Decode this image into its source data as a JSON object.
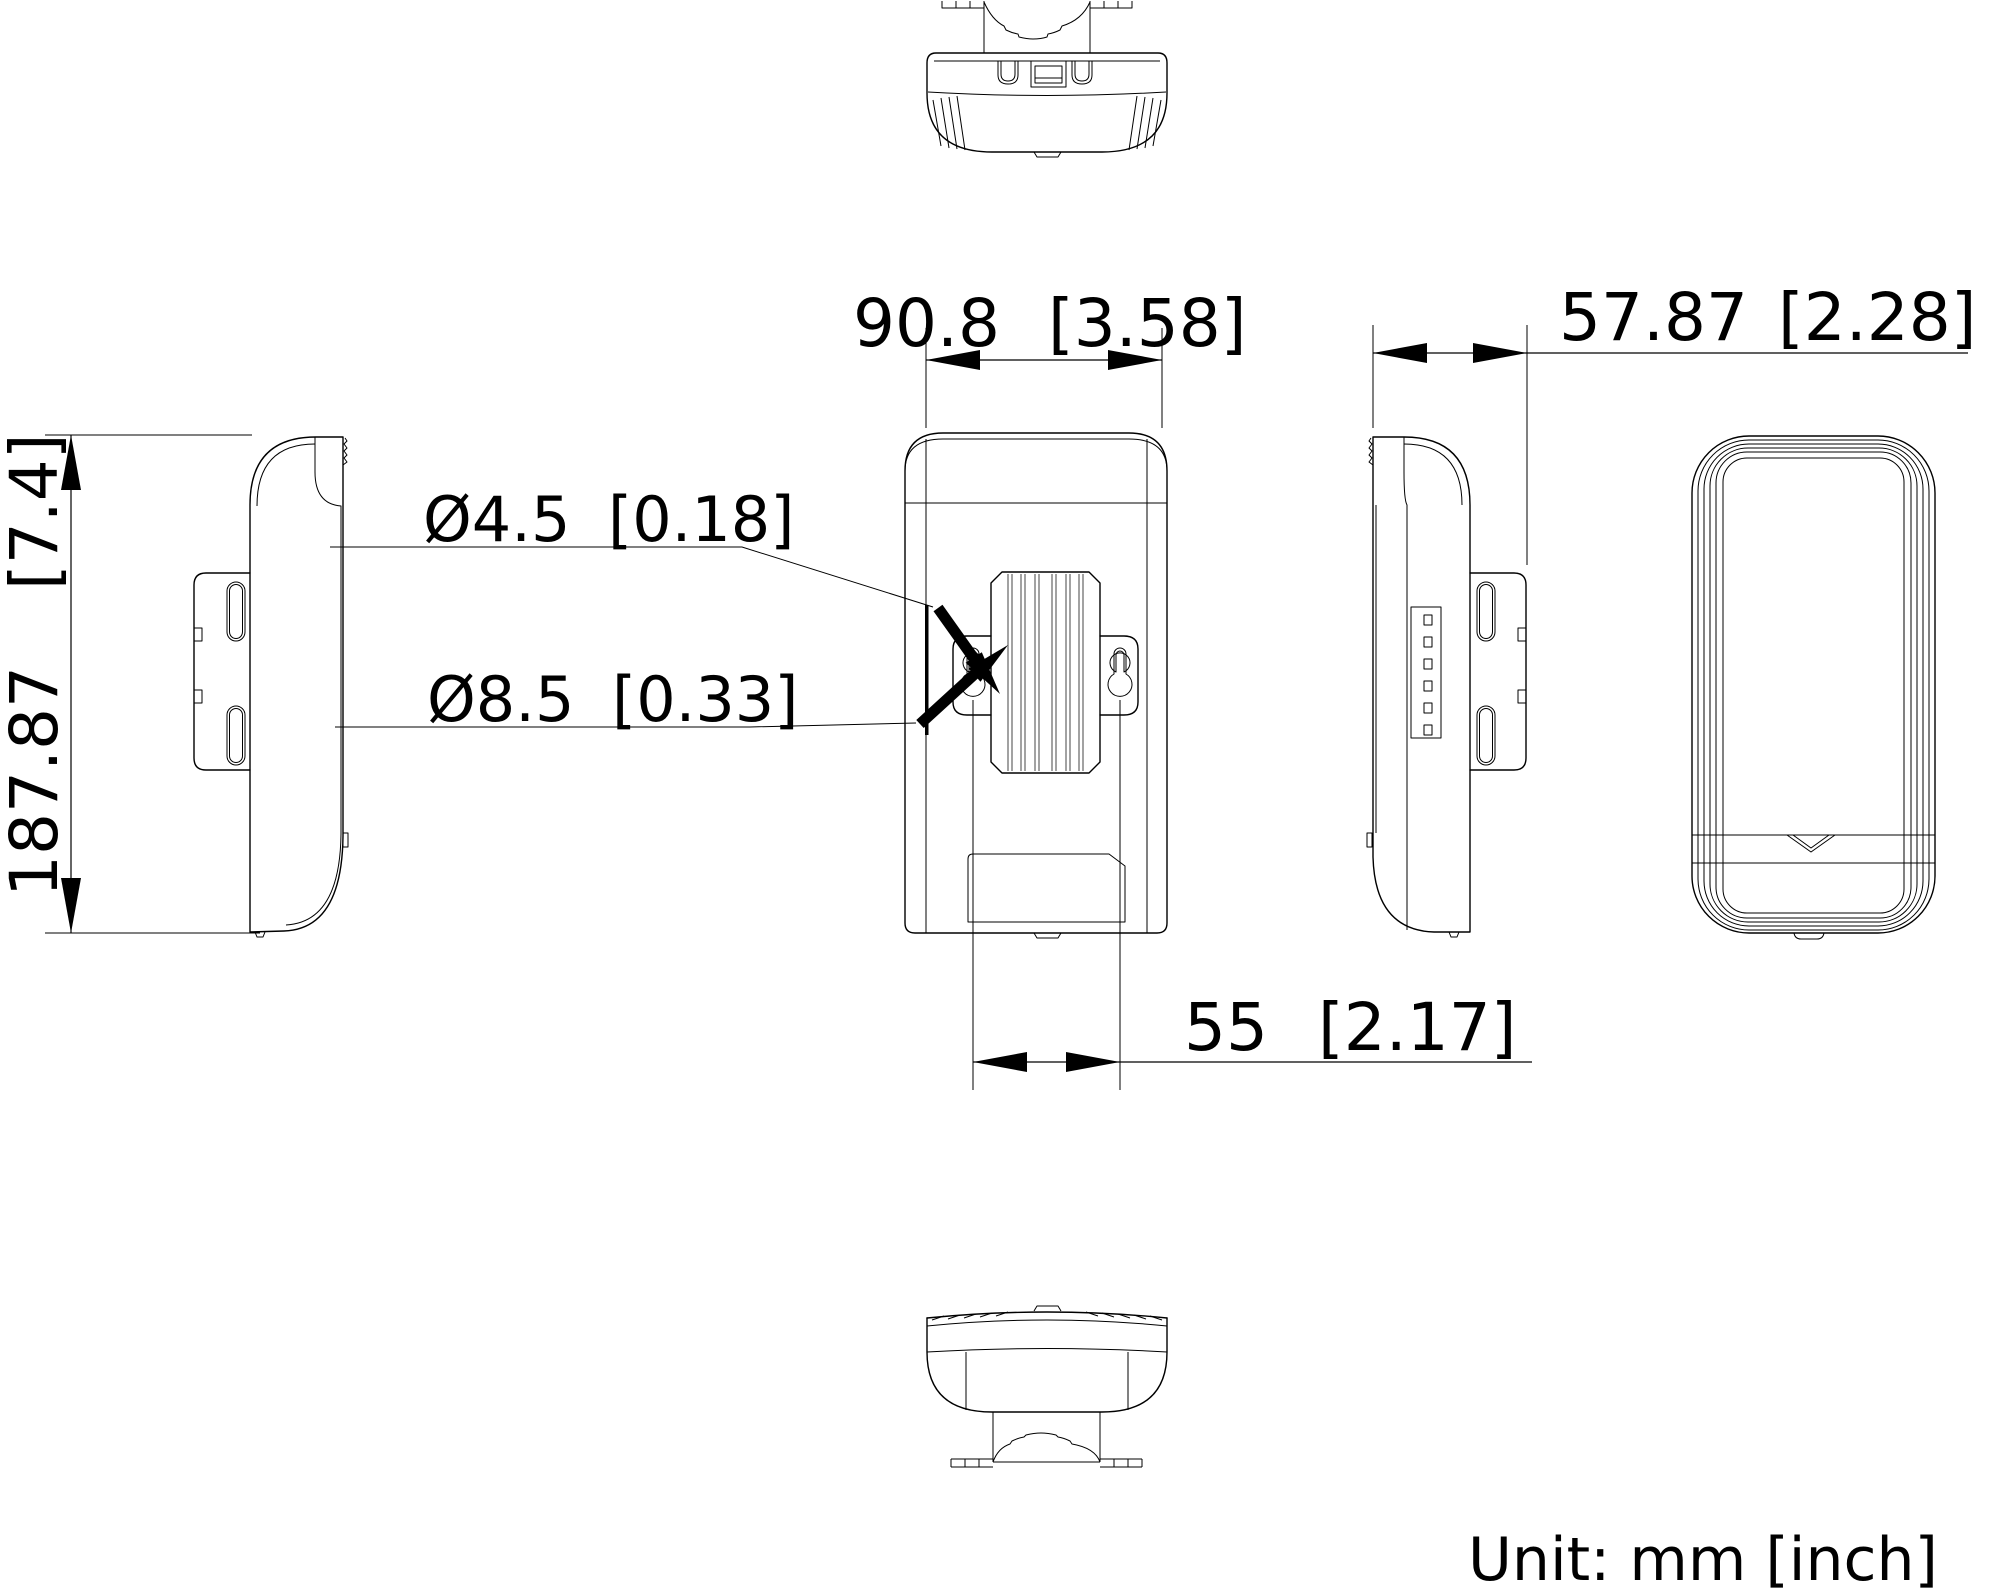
{
  "dimensions": {
    "body_width": {
      "mm": "90.8",
      "inch": "[3.58]"
    },
    "body_depth": {
      "mm": "57.87",
      "inch": "[2.28]"
    },
    "body_height": {
      "mm": "187.87",
      "inch": "[7.4]"
    },
    "keyhole_slot": {
      "mm": "Ø4.5",
      "inch": "[0.18]"
    },
    "keyhole_circle": {
      "mm": "Ø8.5",
      "inch": "[0.33]"
    },
    "hole_spacing": {
      "mm": "55",
      "inch": "[2.17]"
    }
  },
  "footer": {
    "unit_note": "Unit: mm [inch]"
  }
}
